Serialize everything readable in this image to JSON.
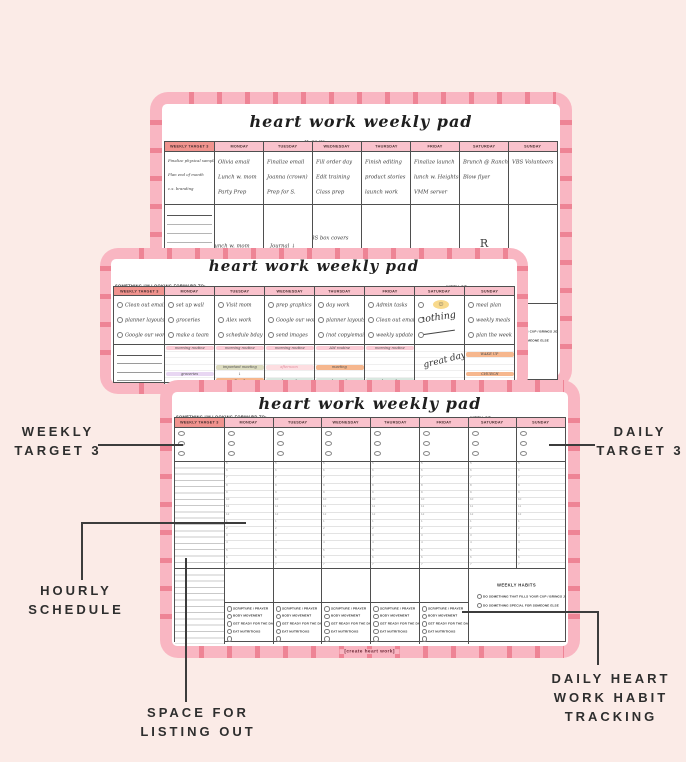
{
  "colors": {
    "background": "#fbebe7",
    "pad_pink": "#f9b6c2",
    "tick_pink": "#ee8495",
    "header_pink": "#f9c2cc",
    "header_salmon": "#f0938e",
    "highlight_yellow": "#f8d98c",
    "highlight_orange": "#f6b78e",
    "highlight_pink": "#fbccd6",
    "highlight_mint": "#d9e8e0",
    "highlight_purple": "#e8d7f2",
    "highlight_olive": "#dddcc0"
  },
  "annotations": {
    "weekly_target": {
      "lines": [
        "WEEKLY",
        "TARGET 3"
      ]
    },
    "daily_target": {
      "lines": [
        "DAILY",
        "TARGET 3"
      ]
    },
    "hourly_schedule": {
      "lines": [
        "HOURLY",
        "SCHEDULE"
      ]
    },
    "space_listing": {
      "lines": [
        "SPACE FOR",
        "LISTING OUT"
      ]
    },
    "habit_tracking": {
      "lines": [
        "DAILY HEART",
        "WORK HABIT",
        "TRACKING"
      ]
    }
  },
  "pad_template": {
    "title": "heart work weekly pad",
    "looking_forward_label": "SOMETHING I'M LOOKING FORWARD TO:",
    "week_of_label": "WEEK OF:",
    "columns": [
      "WEEKLY TARGET 3",
      "MONDAY",
      "TUESDAY",
      "WEDNESDAY",
      "THURSDAY",
      "FRIDAY",
      "SATURDAY",
      "SUNDAY"
    ],
    "hours": [
      "5",
      "6",
      "7",
      "8",
      "9",
      "10",
      "11",
      "12",
      "1",
      "2",
      "3",
      "4",
      "5",
      "6",
      "7",
      "8",
      "9"
    ],
    "daily_habits": [
      "SCRIPTURE / PRAYER",
      "BODY MOVEMENT",
      "GET READY FOR THE DAY",
      "EAT NUTRITIOUS",
      ""
    ],
    "weekly_habits_title": "WEEKLY HABITS",
    "weekly_habits": [
      "DO SOMETHING THAT FILLS YOUR CUP / BRINGS JOY",
      "DO SOMETHING SPECIAL FOR SOMEONE ELSE"
    ],
    "footer": "[create heart work]"
  },
  "back_pad": {
    "looking_forward_value": "♥ SMX",
    "week_of_value": "May 23, 2019",
    "targets": [
      [
        "Finalize physical sample",
        "Plan end of month",
        "c.s. branding"
      ],
      [
        "Olivia email",
        "Lunch w. mom",
        "Party Prep"
      ],
      [
        "Finalize email",
        "Joanna (crown)",
        "Prep for S."
      ],
      [
        "Fill order day",
        "Edit training",
        "Class prep"
      ],
      [
        "Finish editing",
        "product stories",
        "launch work"
      ],
      [
        "Finalize launch",
        "lunch w. Heights",
        "VMM server"
      ],
      [
        "Brunch @ Ranch",
        "Blow flyer"
      ],
      [
        "VBS Volunteers"
      ]
    ],
    "deep_work_list": [
      "DEEP WORK",
      "Planner Pad",
      "Product Stories",
      "Schedule Stories",
      "VBS content",
      "Polish content",
      "Schedule June b-dates",
      "VBS photos"
    ],
    "day_notes": [
      [
        "Lunch w. mom",
        "day work"
      ],
      [
        "Journal ↓",
        "day work"
      ],
      [
        "VBS box covers",
        "day work",
        "VBS meeting"
      ],
      [
        "launch work"
      ],
      [
        "deep work"
      ],
      [
        "R",
        "E"
      ],
      []
    ]
  },
  "middle_pad": {
    "looking_forward_value": "",
    "week_of_value": "",
    "targets": [
      [
        "Clean out email",
        "planner layouts",
        "Google our work"
      ],
      [
        "set up wall",
        "groceries",
        "make a team"
      ],
      [
        "Visit mom",
        "Alex work",
        "schedule bday"
      ],
      [
        "prep graphics",
        "Google our work",
        "send images"
      ],
      [
        "day work",
        "planner layouts",
        "(not copy/email)"
      ],
      [
        "Admin tasks",
        "Clean out email",
        "weekly update"
      ],
      [],
      [
        "meal plan",
        "weekly meals",
        "plan the week"
      ]
    ],
    "saturday_note": "nothing",
    "saturday_smiley": "☺",
    "saturday_script": "great day!",
    "grocery_list": [
      "Groceries:",
      "beef",
      "chicken",
      "pasta",
      "work yogurt",
      "bread",
      "fertilizer",
      "Magnolia"
    ],
    "schedule": [
      [
        [
          "morning routine",
          "pink"
        ],
        [
          "",
          ""
        ],
        [
          "",
          ""
        ],
        [
          "",
          ""
        ],
        [
          "groceries",
          "purple"
        ],
        [
          "",
          ""
        ],
        [
          "",
          ""
        ]
      ],
      [
        [
          "morning routine",
          "pink"
        ],
        [
          "",
          ""
        ],
        [
          "",
          ""
        ],
        [
          "important meeting",
          "olive"
        ],
        [
          "↓",
          ""
        ],
        [
          "Email",
          "orange"
        ],
        [
          "",
          ""
        ]
      ],
      [
        [
          "morning routine",
          "pink"
        ],
        [
          "",
          ""
        ],
        [
          "",
          ""
        ],
        [
          "afternoon",
          "lightpink"
        ],
        [
          "",
          ""
        ],
        [
          "day work",
          "mint"
        ],
        [
          "",
          ""
        ]
      ],
      [
        [
          "AM routine",
          "pink"
        ],
        [
          "",
          ""
        ],
        [
          "",
          ""
        ],
        [
          "meeting",
          "orange"
        ],
        [
          "",
          ""
        ],
        [
          "day work",
          "mint"
        ],
        [
          "",
          ""
        ]
      ],
      [
        [
          "morning routine",
          "pink"
        ],
        [
          "",
          ""
        ],
        [
          "",
          ""
        ],
        [
          "",
          ""
        ],
        [
          "",
          ""
        ],
        [
          "day work",
          "mint"
        ],
        [
          "",
          ""
        ]
      ],
      [
        [
          "",
          ""
        ],
        [
          "",
          ""
        ],
        [
          "",
          ""
        ],
        [
          "",
          ""
        ],
        [
          "",
          ""
        ],
        [
          "",
          ""
        ],
        [
          "",
          ""
        ]
      ],
      [
        [
          "",
          ""
        ],
        [
          "WAKE UP",
          "orange"
        ],
        [
          "",
          ""
        ],
        [
          "",
          ""
        ],
        [
          "CHURCH",
          "orange"
        ],
        [
          "",
          ""
        ],
        [
          "",
          ""
        ]
      ]
    ]
  }
}
